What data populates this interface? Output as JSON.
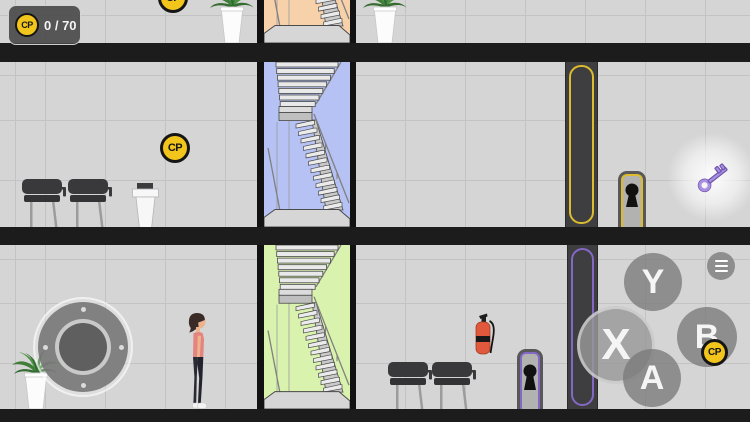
{
  "hud": {
    "coin_label": "CP",
    "progress": "0 / 70"
  },
  "coin": {
    "label": "CP",
    "fill": "#f2c51d",
    "border": "#151515"
  },
  "world": {
    "stairwells": [
      {
        "floor": "top",
        "color": "#f6d1a9"
      },
      {
        "floor": "middle",
        "color": "#b5c2f3"
      },
      {
        "floor": "bottom",
        "color": "#d9f2ad"
      }
    ],
    "key": {
      "color": "#a98fe0",
      "outline": "#6f55ad"
    },
    "accents": {
      "locked_door_middle": "#dcbc2e",
      "locked_door_bottom": "#8468c5"
    }
  },
  "controls": {
    "y_label": "Y",
    "x_label": "X",
    "b_label": "B",
    "a_label": "A",
    "menu_icon": "hamburger-menu"
  }
}
